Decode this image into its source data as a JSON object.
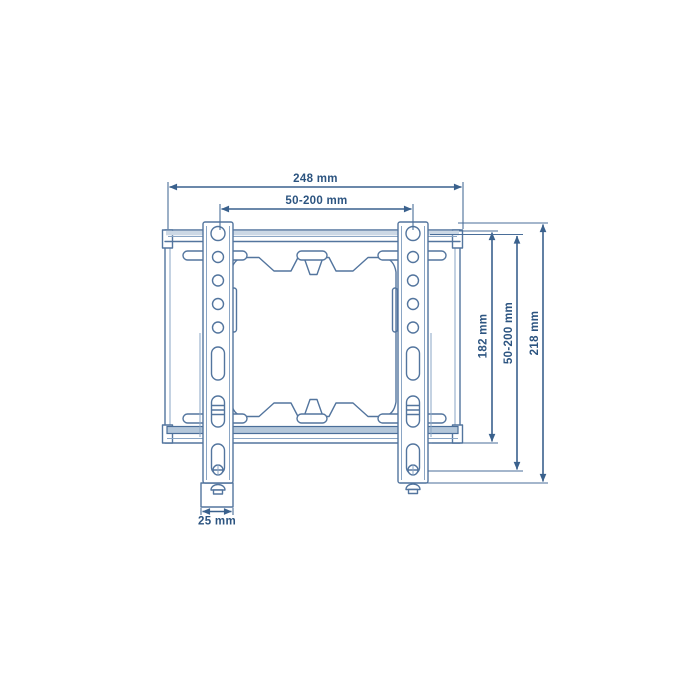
{
  "diagram": {
    "title": "TV wall-mount bracket technical drawing, front view",
    "background_color": "#ffffff",
    "line_color": "#53759e",
    "dimension_line_color": "#3a618d",
    "text_color": "#2c5480",
    "band_fill_color": "#b4c7da",
    "dimensions": {
      "total_width": {
        "label": "248 mm",
        "orientation": "horizontal"
      },
      "hole_span_width": {
        "label": "50-200 mm",
        "orientation": "horizontal"
      },
      "plate_height": {
        "label": "182 mm",
        "orientation": "vertical"
      },
      "hole_span_height": {
        "label": "50-200 mm",
        "orientation": "vertical"
      },
      "total_height": {
        "label": "218 mm",
        "orientation": "vertical"
      },
      "arm_width": {
        "label": "25 mm",
        "orientation": "horizontal"
      }
    }
  }
}
